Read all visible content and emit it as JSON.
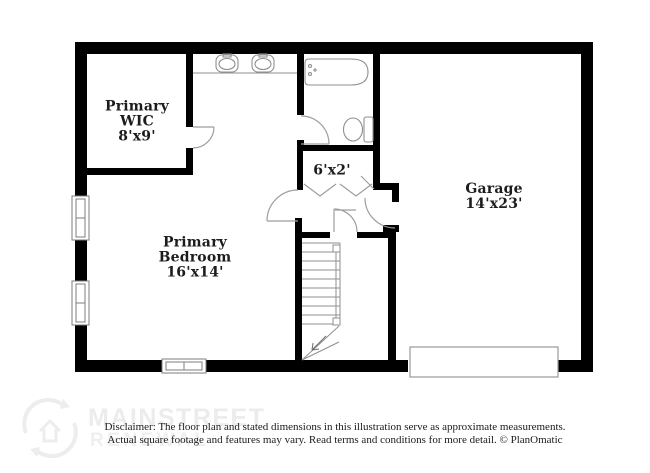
{
  "canvas": {
    "width": 650,
    "height": 473,
    "background": "#ffffff"
  },
  "floor_plan": {
    "rooms": [
      {
        "id": "primary-wic",
        "lines": [
          "Primary",
          "WIC"
        ],
        "dims": "8'x9'"
      },
      {
        "id": "primary-bedroom",
        "lines": [
          "Primary",
          "Bedroom"
        ],
        "dims": "16'x14'"
      },
      {
        "id": "hall-closet",
        "lines": [],
        "dims": "6'x2'"
      },
      {
        "id": "garage",
        "lines": [
          "Garage"
        ],
        "dims": "14'x23'"
      }
    ],
    "fixtures": [
      "double-vanity-sinks",
      "bathtub",
      "toilet",
      "staircase",
      "stair-direction-arrow",
      "bifold-closet-doors",
      "hinged-door-swings",
      "double-hung-windows",
      "garage-door-panel"
    ],
    "colors": {
      "wall": "#000000",
      "fixture_line": "#8f8f8f",
      "door_line": "#9e9e9e",
      "label_text": "#1c1c1c"
    }
  },
  "watermark": {
    "brand_line1": "MAINSTREET",
    "brand_line2": "RENEWAL",
    "logo": "mainstreet-circular-house-logo",
    "color": "#ededed"
  },
  "disclaimer": {
    "line1": "Disclaimer: The floor plan and stated dimensions in this illustration serve as approximate measurements.",
    "line2": "Actual square footage and features may vary. Read terms and conditions for more detail. © PlanOmatic"
  }
}
